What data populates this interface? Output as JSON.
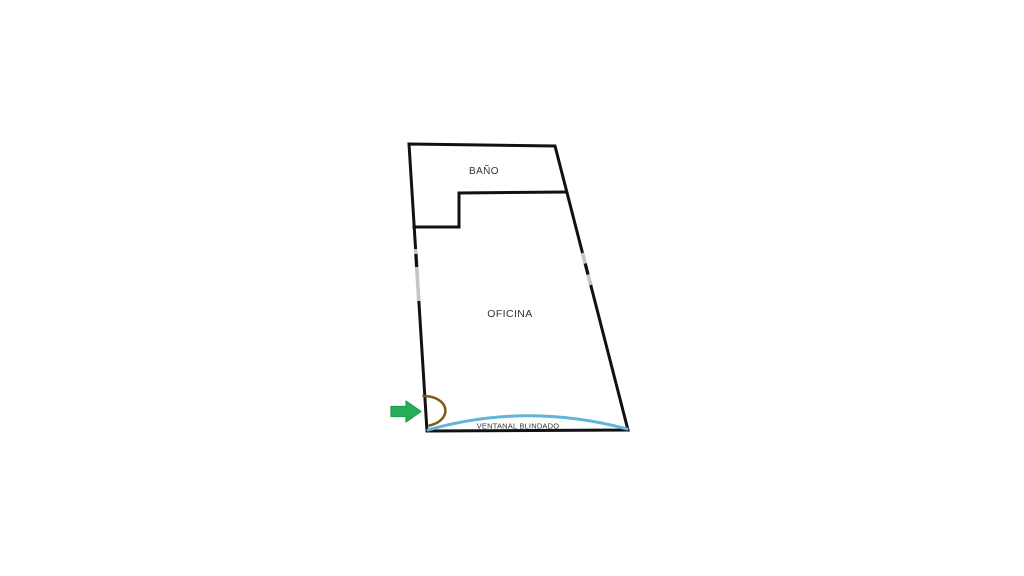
{
  "floorplan": {
    "title": "office-floorplan",
    "labels": {
      "bathroom": "BAÑO",
      "office": "OFICINA",
      "armored_window": "VENTANAL BLINDADO"
    },
    "colors": {
      "wall": "#111111",
      "window_gap": "#c6c6c6",
      "armored_window": "#5fb6d9",
      "door_swing": "#7a5a14",
      "arrow_green": "#28ae5a",
      "arrow_green_dark": "#1d9e4f",
      "label_text": "#333333"
    }
  }
}
